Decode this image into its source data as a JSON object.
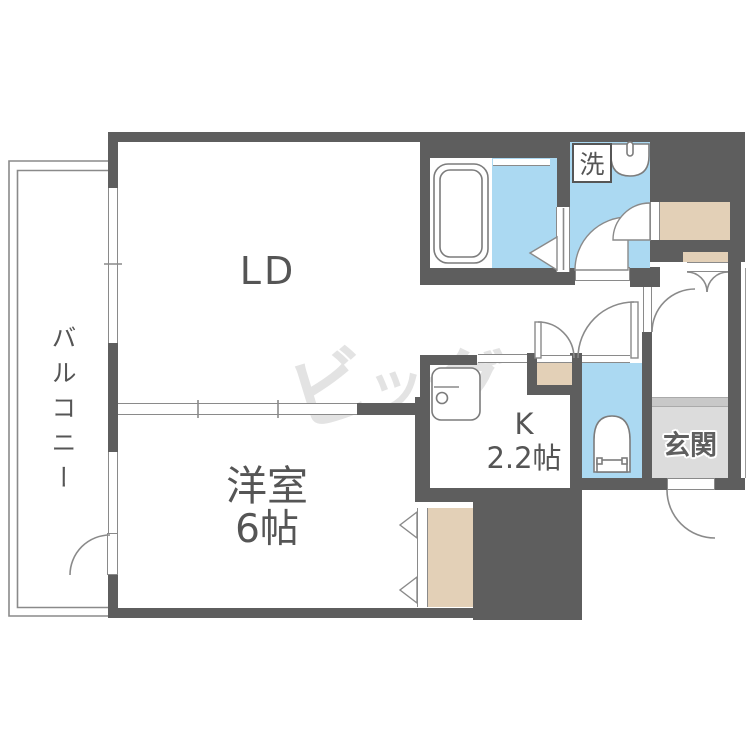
{
  "rooms": {
    "living_dining": {
      "label": "LD"
    },
    "balcony": {
      "label": "バルコニー"
    },
    "western_room": {
      "label": "洋室",
      "size": "6帖"
    },
    "kitchen": {
      "label": "K",
      "size": "2.2帖"
    },
    "entrance": {
      "label": "玄関"
    },
    "washroom": {
      "washer_label": "洗"
    }
  },
  "watermark": {
    "text": "ビッグ",
    "chars": [
      "ビ",
      "ッ",
      "グ"
    ]
  },
  "fixtures": [
    "bathtub",
    "wash-basin",
    "washing-machine-space",
    "toilet",
    "kitchen-sink"
  ],
  "colors": {
    "wall": "#5e5e5e",
    "water_area": "#abd9f2",
    "closet": "#e3d0b7",
    "entrance_floor": "#dcdcdc",
    "entrance_step": "#c8c8c8",
    "line": "#8a8a8a",
    "label_text": "#555555",
    "watermark": "#e3e3e3"
  }
}
